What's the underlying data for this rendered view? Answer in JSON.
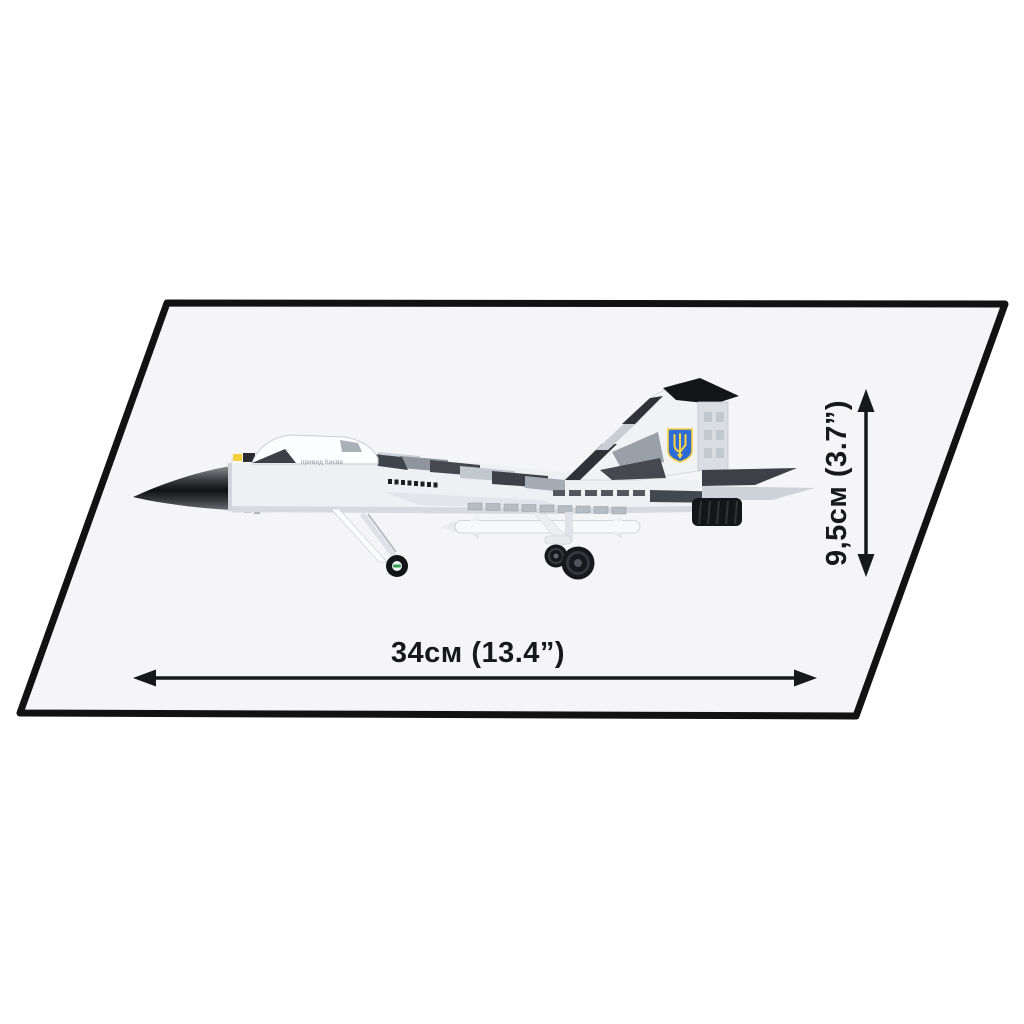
{
  "diagram": {
    "kind": "product-dimension-diagram",
    "aircraft_marking": "привид Києва",
    "dimensions": {
      "width_label": "34см (13.4”)",
      "height_label": "9,5см (3.7”)"
    },
    "emblem": {
      "icon": "ukrainian-trident-shield",
      "shield_color": "#2E6CD4",
      "trident_color": "#FFD23F"
    },
    "colors": {
      "panel_fill": "#F5F5F7",
      "panel_border": "#121212",
      "arrow": "#17181A",
      "camo_white": "#F3F4F6",
      "camo_light_grey": "#CDD1D8",
      "camo_mid_grey": "#9BA0A9",
      "camo_dark_grey": "#3F434A",
      "nozzle_black": "#141518",
      "nose_cone_dark": "#101113",
      "wheel_hub_green": "#2E9E4F",
      "nose_yellow": "#F4D03A"
    }
  }
}
